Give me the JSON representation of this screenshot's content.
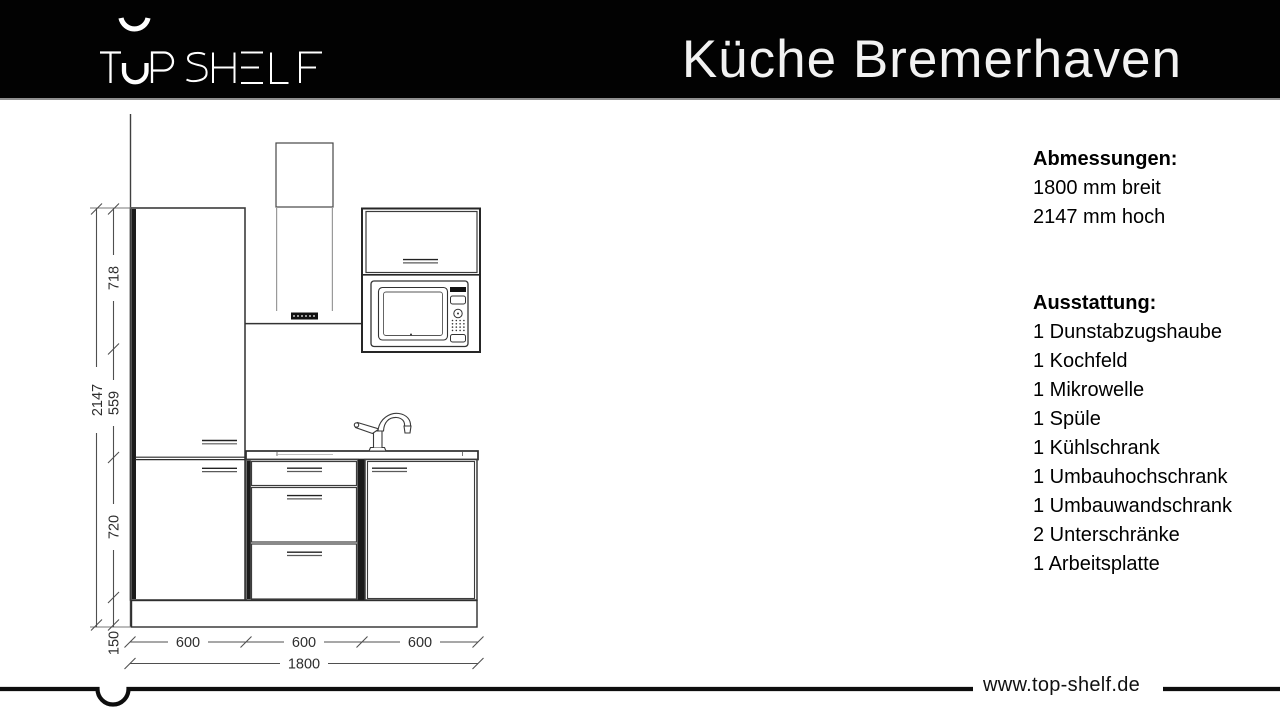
{
  "header": {
    "logo_text": "TOP SHELF",
    "title": "Küche Bremerhaven",
    "bg_color": "#000000",
    "text_color": "#f2f2f2"
  },
  "specs": {
    "dimensions_heading": "Abmessungen:",
    "dimensions": [
      "1800 mm breit",
      "2147 mm hoch"
    ],
    "features_heading": "Ausstattung:",
    "features": [
      "1 Dunstabzugshaube",
      "1 Kochfeld",
      "1 Mikrowelle",
      "1 Spüle",
      "1 Kühlschrank",
      "1 Umbauhochschrank",
      "1 Umbauwandschrank",
      "2 Unterschränke",
      "1 Arbeitsplatte"
    ]
  },
  "drawing": {
    "labels": {
      "total_height": "2147",
      "wall_section_height": "718",
      "mid_section_height": "559",
      "base_height": "720",
      "plinth_height": "150",
      "widths": [
        "600",
        "600",
        "600"
      ],
      "total_width": "1800"
    },
    "line_color": "#3c3c3c"
  },
  "footer": {
    "website": "www.top-shelf.de"
  }
}
